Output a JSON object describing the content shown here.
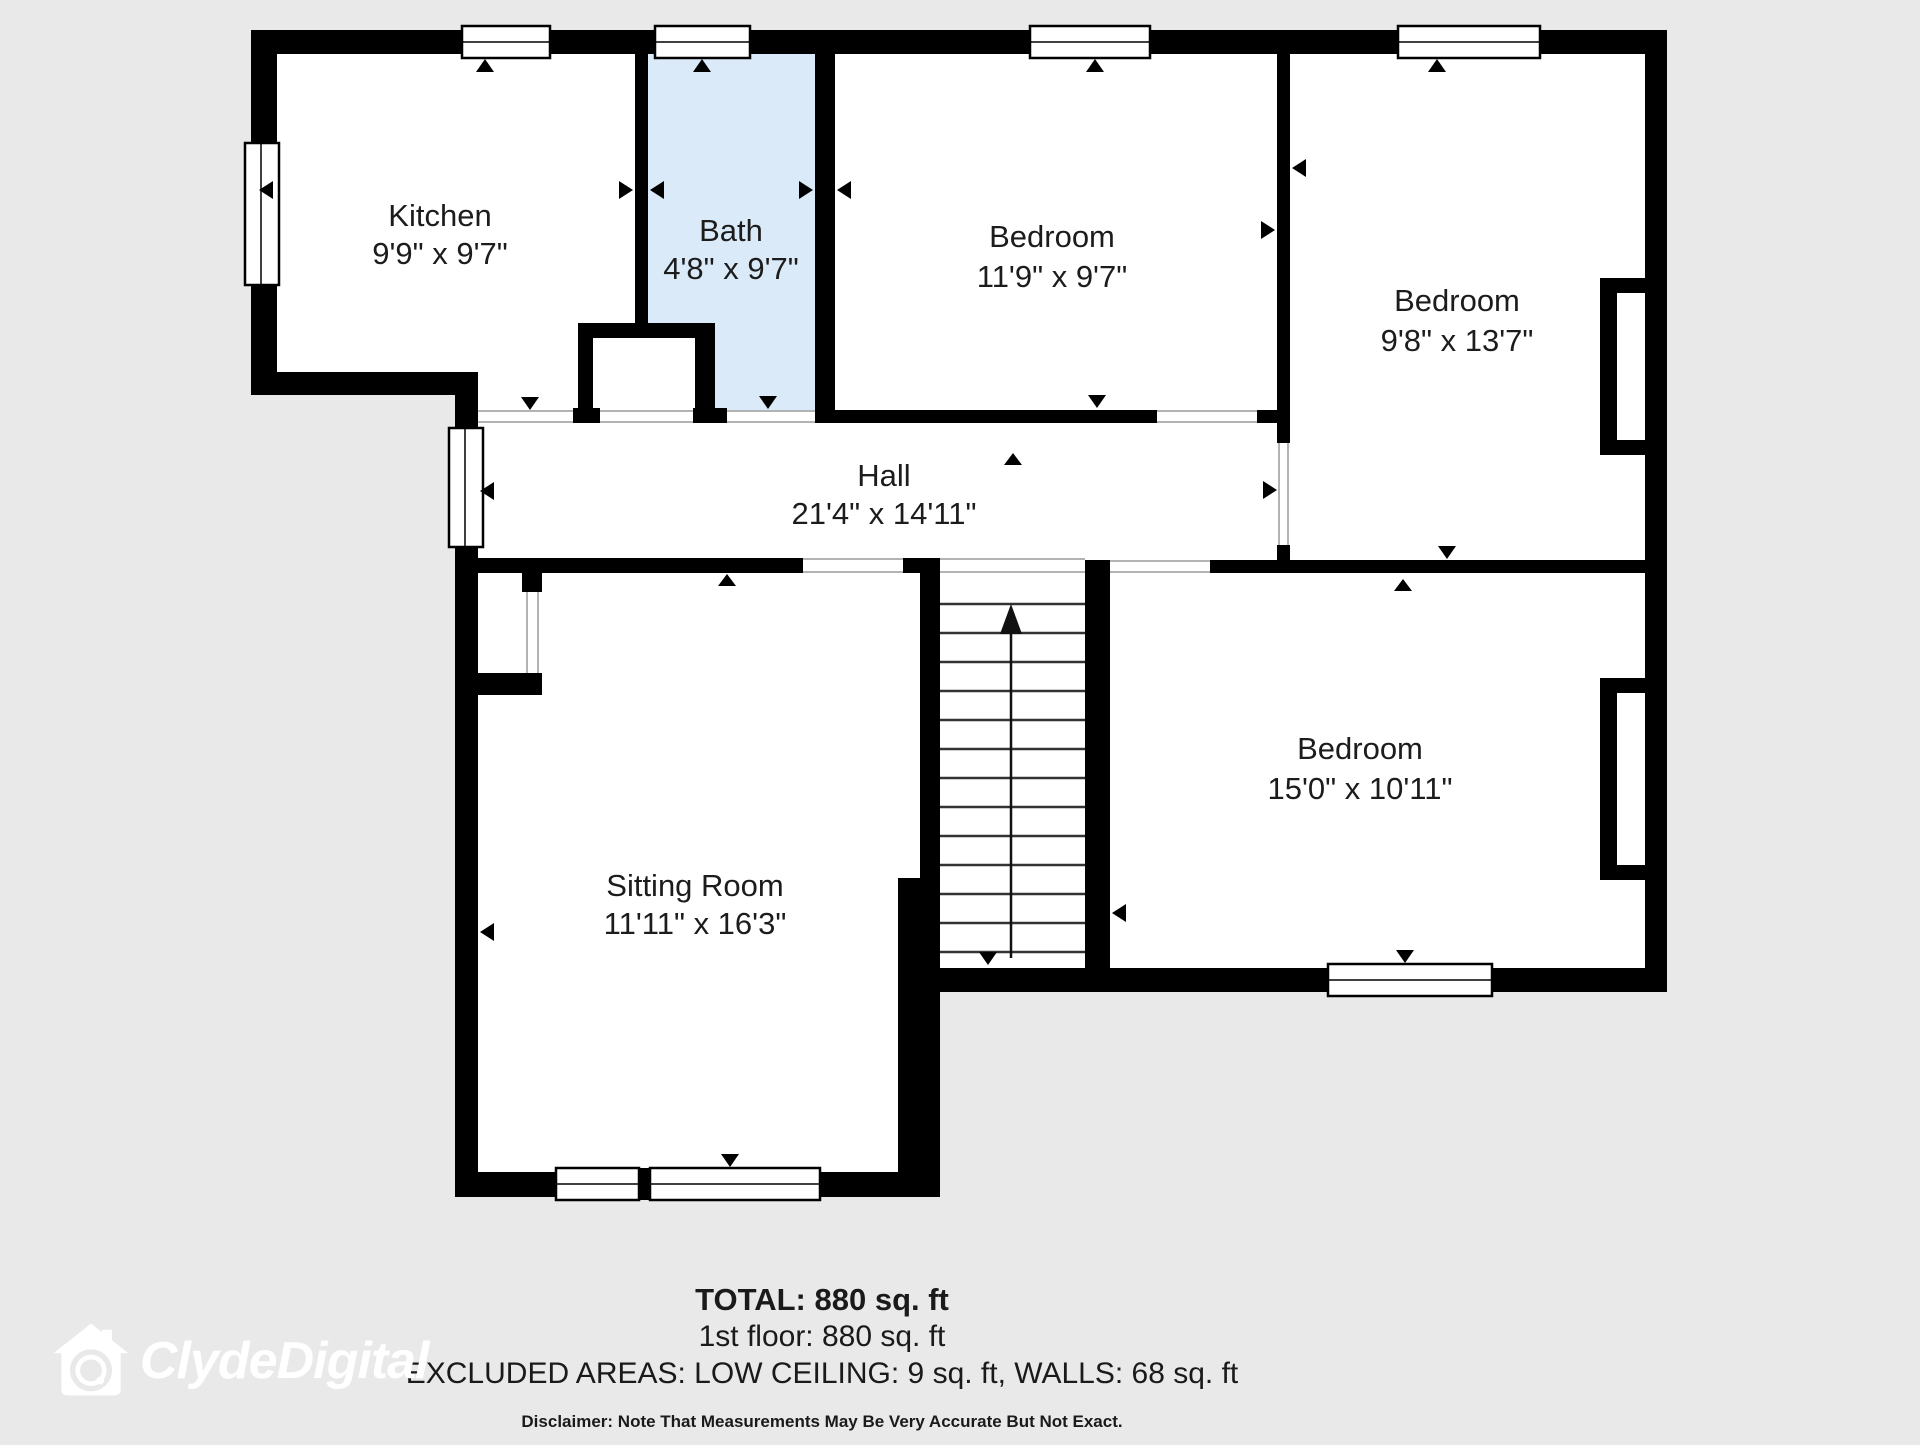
{
  "floorplan": {
    "rooms": [
      {
        "id": "kitchen",
        "name": "Kitchen",
        "dims": "9'9\" x 9'7\""
      },
      {
        "id": "bath",
        "name": "Bath",
        "dims": "4'8\" x 9'7\""
      },
      {
        "id": "bedroom-top-middle",
        "name": "Bedroom",
        "dims": "11'9\" x 9'7\""
      },
      {
        "id": "bedroom-top-right",
        "name": "Bedroom",
        "dims": "9'8\" x 13'7\""
      },
      {
        "id": "hall",
        "name": "Hall",
        "dims": "21'4\" x 14'11\""
      },
      {
        "id": "sitting-room",
        "name": "Sitting Room",
        "dims": "11'11\" x 16'3\""
      },
      {
        "id": "bedroom-bottom-right",
        "name": "Bedroom",
        "dims": "15'0\" x 10'11\""
      }
    ],
    "colors": {
      "wall": "#000000",
      "room_fill": "#ffffff",
      "bath_fill": "#daeaf8",
      "background": "#e9e9e9"
    }
  },
  "summary": {
    "total": "TOTAL: 880 sq. ft",
    "floor": "1st floor: 880 sq. ft",
    "excluded": "EXCLUDED AREAS: LOW CEILING: 9 sq. ft, WALLS: 68 sq. ft",
    "disclaimer": "Disclaimer: Note That Measurements May Be Very Accurate But Not Exact."
  },
  "branding": {
    "logo_text": "ClydeDigital"
  }
}
